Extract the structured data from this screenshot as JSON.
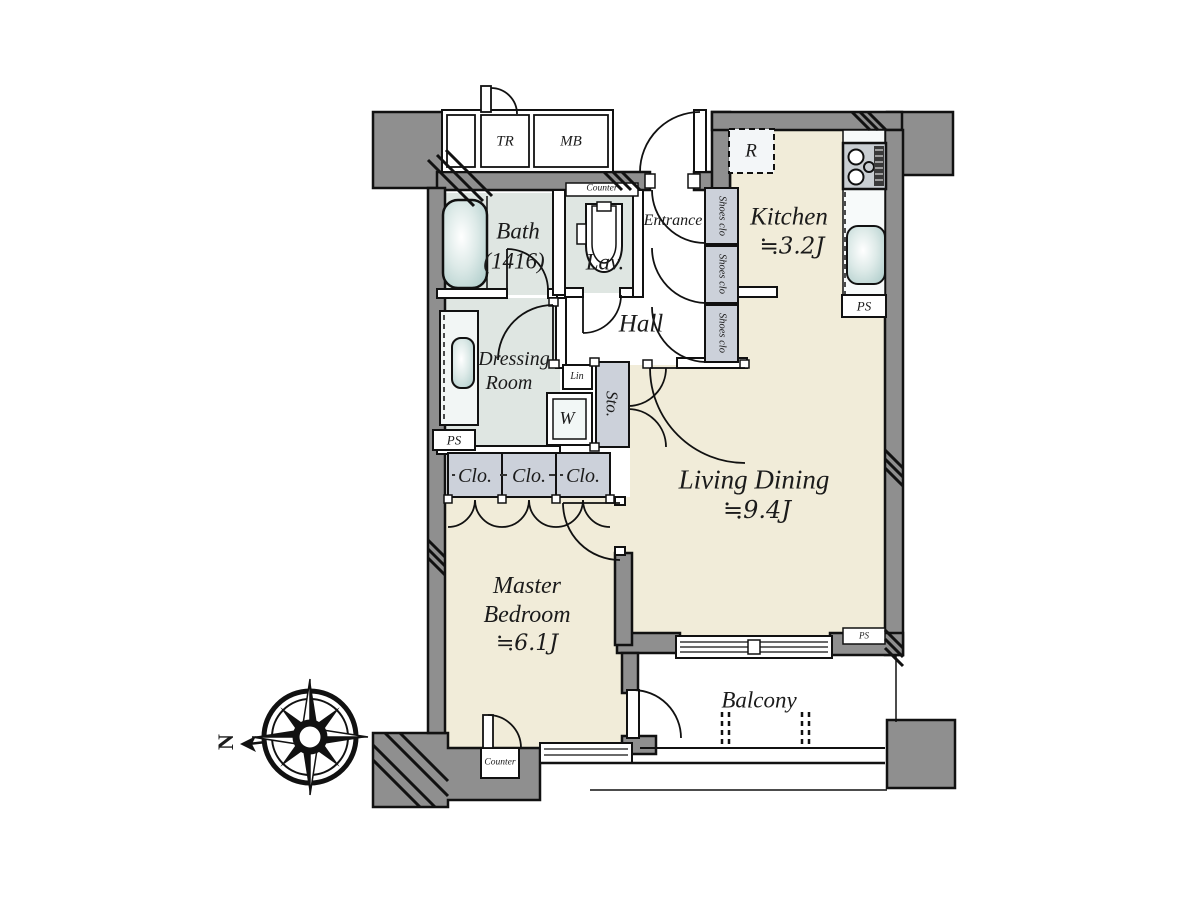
{
  "rooms": {
    "entrance": {
      "name": "Entrance"
    },
    "hall": {
      "name": "Hall"
    },
    "kitchen": {
      "name": "Kitchen",
      "area": "≒3.2J"
    },
    "living_dining": {
      "name": "Living Dining",
      "area": "≒9.4J"
    },
    "master_bedroom": {
      "name1": "Master",
      "name2": "Bedroom",
      "area": "≒6.1J"
    },
    "bath": {
      "name": "Bath",
      "size": "(1416)"
    },
    "lavatory": {
      "name": "Lav."
    },
    "dressing_room": {
      "name1": "Dressing",
      "name2": "Room"
    },
    "balcony": {
      "name": "Balcony"
    }
  },
  "labels": {
    "trunk_room": "TR",
    "meter_box": "MB",
    "refrigerator": "R",
    "pipe_space": "PS",
    "shoes_closet": "Shoes clo",
    "closet": "Clo.",
    "storage": "Sto.",
    "linen": "Lin",
    "washer": "W",
    "counter": "Counter",
    "north": "N"
  },
  "colors": {
    "room_beige": "#f1ecd9",
    "wet_area": "#dfe6e2",
    "wall_gray": "#8f8f8f",
    "closet_gray": "#ccd1da",
    "fixture_teal": "#b9d4d2",
    "line_black": "#1a1a1a"
  }
}
